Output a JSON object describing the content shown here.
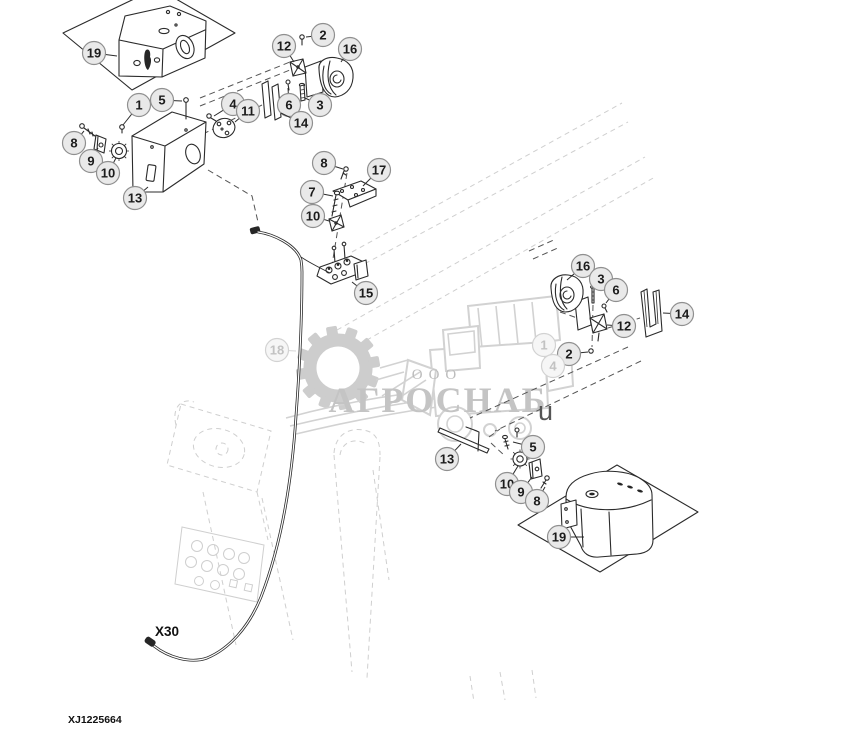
{
  "diagram": {
    "drawing_number": "XJ1225664",
    "harness_connector_label": "X30",
    "callouts": [
      {
        "n": "19",
        "cx": 94,
        "cy": 53,
        "tx": 117,
        "ty": 56
      },
      {
        "n": "1",
        "cx": 139,
        "cy": 105,
        "tx": 123,
        "ty": 125
      },
      {
        "n": "5",
        "cx": 162,
        "cy": 100,
        "tx": 182,
        "ty": 101
      },
      {
        "n": "8",
        "cx": 74,
        "cy": 143,
        "tx": 84,
        "ty": 131
      },
      {
        "n": "9",
        "cx": 91,
        "cy": 161,
        "tx": 98,
        "ty": 148
      },
      {
        "n": "10",
        "cx": 108,
        "cy": 173,
        "tx": 116,
        "ty": 158
      },
      {
        "n": "13",
        "cx": 135,
        "cy": 198,
        "tx": 148,
        "ty": 187
      },
      {
        "n": "4",
        "cx": 233,
        "cy": 104,
        "tx": 214,
        "ty": 116
      },
      {
        "n": "11",
        "cx": 248,
        "cy": 111,
        "tx": 235,
        "ty": 122
      },
      {
        "n": "12",
        "cx": 284,
        "cy": 46,
        "tx": 294,
        "ty": 62
      },
      {
        "n": "2",
        "cx": 323,
        "cy": 35,
        "tx": 306,
        "ty": 37
      },
      {
        "n": "16",
        "cx": 350,
        "cy": 49,
        "tx": 341,
        "ty": 62
      },
      {
        "n": "6",
        "cx": 289,
        "cy": 105,
        "tx": 288,
        "ty": 88
      },
      {
        "n": "3",
        "cx": 320,
        "cy": 105,
        "tx": 305,
        "ty": 98
      },
      {
        "n": "14",
        "cx": 301,
        "cy": 123,
        "tx": 281,
        "ty": 113
      },
      {
        "n": "8",
        "cx": 324,
        "cy": 163,
        "tx": 343,
        "ty": 169
      },
      {
        "n": "17",
        "cx": 379,
        "cy": 170,
        "tx": 363,
        "ty": 186
      },
      {
        "n": "7",
        "cx": 312,
        "cy": 192,
        "tx": 333,
        "ty": 196
      },
      {
        "n": "10",
        "cx": 313,
        "cy": 216,
        "tx": 329,
        "ty": 221
      },
      {
        "n": "15",
        "cx": 366,
        "cy": 293,
        "tx": 352,
        "ty": 282
      },
      {
        "n": "18",
        "cx": 277,
        "cy": 350,
        "tx": 296,
        "ty": 351,
        "faded": true
      },
      {
        "n": "16",
        "cx": 583,
        "cy": 266,
        "tx": 567,
        "ty": 280
      },
      {
        "n": "3",
        "cx": 601,
        "cy": 279,
        "tx": 594,
        "ty": 288
      },
      {
        "n": "6",
        "cx": 616,
        "cy": 290,
        "tx": 606,
        "ty": 303
      },
      {
        "n": "12",
        "cx": 624,
        "cy": 326,
        "tx": 607,
        "ty": 325
      },
      {
        "n": "2",
        "cx": 569,
        "cy": 354,
        "tx": 588,
        "ty": 352
      },
      {
        "n": "14",
        "cx": 682,
        "cy": 314,
        "tx": 663,
        "ty": 313
      },
      {
        "n": "1",
        "cx": 544,
        "cy": 345,
        "faded": true
      },
      {
        "n": "4",
        "cx": 553,
        "cy": 366,
        "faded": true
      },
      {
        "n": "5",
        "cx": 533,
        "cy": 447,
        "tx": 513,
        "ty": 442
      },
      {
        "n": "13",
        "cx": 447,
        "cy": 459,
        "tx": 461,
        "ty": 444
      },
      {
        "n": "10",
        "cx": 507,
        "cy": 484,
        "tx": 518,
        "ty": 466
      },
      {
        "n": "9",
        "cx": 521,
        "cy": 492,
        "tx": 532,
        "ty": 477
      },
      {
        "n": "8",
        "cx": 537,
        "cy": 501,
        "tx": 545,
        "ty": 487
      },
      {
        "n": "19",
        "cx": 559,
        "cy": 537,
        "tx": 584,
        "ty": 537
      }
    ]
  },
  "watermark": {
    "org_type": "ООО",
    "org_name": "АГРОСНАБ",
    "stray_char": "u"
  },
  "colors": {
    "line": "#2b2b2b",
    "watermark_gray": "#cdcdcd",
    "bubble_fill": "#e9e9e9",
    "bubble_stroke": "#8f8f8f",
    "background": "#ffffff"
  }
}
